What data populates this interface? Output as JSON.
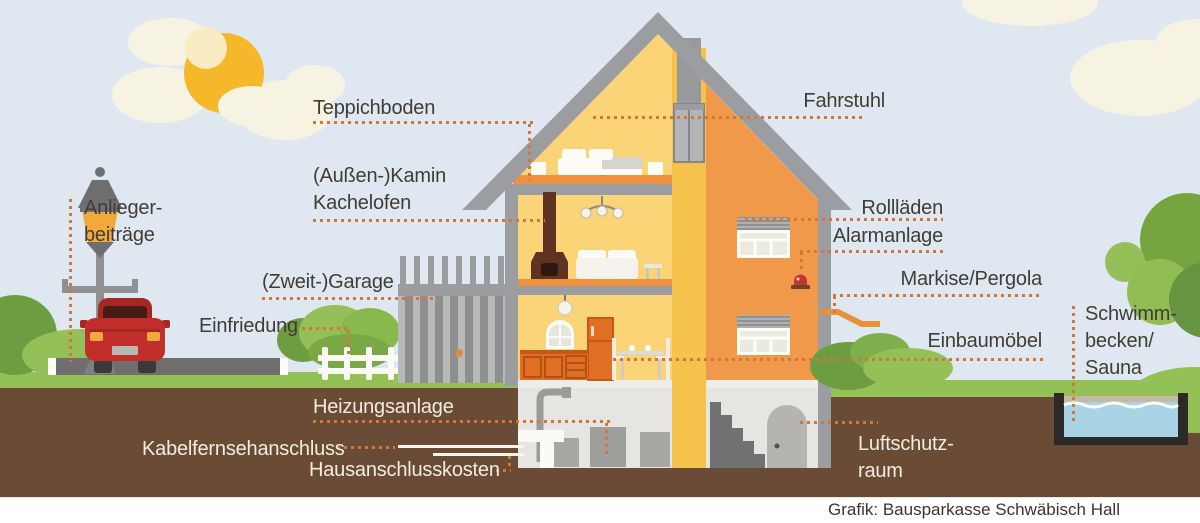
{
  "palette": {
    "sky": "#dfe8f0",
    "sun": "#f5b82a",
    "cloud": "#f7f3e3",
    "roof_gray": "#9b9da0",
    "interior_yellow": "#fbd478",
    "facade_orange": "#f0994a",
    "shaft_amber": "#f5c34c",
    "carpet_orange": "#ee9140",
    "kitchen_orange": "#e06e23",
    "chimney_brown": "#5f3222",
    "ground_brown": "#6a4c36",
    "grass_green": "#94c155",
    "bush_dark": "#6e9c41",
    "bush_light": "#95bf58",
    "road_gray": "#6f6f6f",
    "car_red": "#c22f2b",
    "pool_water": "#a8d4e6",
    "basement_gray": "#e7e5e1",
    "leader_dot": "#d4763a",
    "text_dark": "#413c35",
    "text_light": "#f2ecdf"
  },
  "labels": {
    "teppichboden": "Teppichboden",
    "kamin_l1": "(Außen-)Kamin",
    "kamin_l2": "Kachelofen",
    "garage": "(Zweit-)Garage",
    "einfriedung": "Einfriedung",
    "anlieger_l1": "Anlieger-",
    "anlieger_l2": "beiträge",
    "heizungsanlage": "Heizungsanlage",
    "kabelfernseh": "Kabelfernsehanschluss",
    "hausanschluss": "Hausanschlusskosten",
    "fahrstuhl": "Fahrstuhl",
    "rolllaeden": "Rollläden",
    "alarmanlage": "Alarmanlage",
    "markise": "Markise/Pergola",
    "einbaumoebel": "Einbaumöbel",
    "schwimm_l1": "Schwimm-",
    "schwimm_l2": "becken/",
    "schwimm_l3": "Sauna",
    "luftschutz_l1": "Luftschutz-",
    "luftschutz_l2": "raum"
  },
  "credit": "Grafik: Bausparkasse Schwäbisch Hall"
}
